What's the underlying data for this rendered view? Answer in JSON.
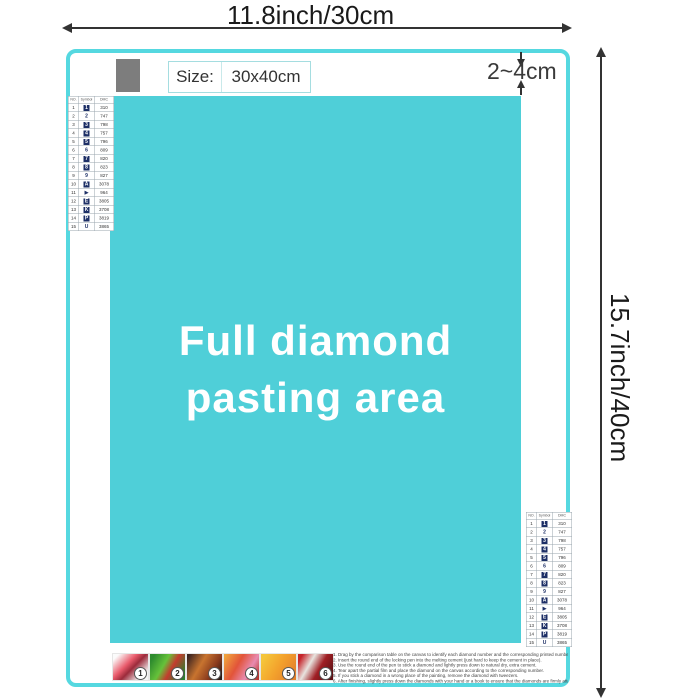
{
  "dimensions": {
    "width_label": "11.8inch/30cm",
    "height_label": "15.7inch/40cm",
    "margin_label": "2~4cm"
  },
  "size_box": {
    "label": "Size:",
    "value": "30x40cm"
  },
  "pasting_area": {
    "line1": "Full diamond",
    "line2": "pasting area",
    "fill_color": "#4fcfd8",
    "border_color": "#55d8e0",
    "gray_swatch_color": "#7d7d7d"
  },
  "color_chart": {
    "headers": {
      "no": "NO.",
      "symbol": "Symbol",
      "code": "DMC"
    },
    "symbol_fill_color": "#1d2f66",
    "rows": [
      {
        "no": "1",
        "symbol": "1",
        "code": "310",
        "filled": true
      },
      {
        "no": "2",
        "symbol": "2",
        "code": "747",
        "filled": false
      },
      {
        "no": "3",
        "symbol": "3",
        "code": "798",
        "filled": true
      },
      {
        "no": "4",
        "symbol": "4",
        "code": "757",
        "filled": true
      },
      {
        "no": "5",
        "symbol": "5",
        "code": "796",
        "filled": true
      },
      {
        "no": "6",
        "symbol": "6",
        "code": "809",
        "filled": false
      },
      {
        "no": "7",
        "symbol": "7",
        "code": "820",
        "filled": true
      },
      {
        "no": "8",
        "symbol": "8",
        "code": "823",
        "filled": true
      },
      {
        "no": "9",
        "symbol": "9",
        "code": "827",
        "filled": false
      },
      {
        "no": "10",
        "symbol": "A",
        "code": "3078",
        "filled": true
      },
      {
        "no": "11",
        "symbol": "▶",
        "code": "964",
        "filled": false
      },
      {
        "no": "12",
        "symbol": "E",
        "code": "3805",
        "filled": true
      },
      {
        "no": "13",
        "symbol": "K",
        "code": "3708",
        "filled": true
      },
      {
        "no": "14",
        "symbol": "P",
        "code": "3819",
        "filled": true
      },
      {
        "no": "15",
        "symbol": "U",
        "code": "3865",
        "filled": false
      }
    ]
  },
  "steps": {
    "images": [
      {
        "num": "1",
        "bg": "linear-gradient(135deg, #fbfbfb 10%, #e8596a 40%, #9c2b3b 55%, #f3f3f3 85%)"
      },
      {
        "num": "2",
        "bg": "linear-gradient(120deg, #2e8b2e 10%, #66c23a 40%, #c43b2e 60%, #2e7d2e 90%)"
      },
      {
        "num": "3",
        "bg": "linear-gradient(120deg, #3a2320 5%, #c8742f 40%, #8a3b1d 70%, #2b1a14 95%)"
      },
      {
        "num": "4",
        "bg": "linear-gradient(120deg, #f0a23c 5%, #e2543a 40%, #e88bb0 70%, #b8352f 95%)"
      },
      {
        "num": "5",
        "bg": "linear-gradient(120deg, #f5c53a 10%, #f3a12c 50%, #e4812b 90%)"
      },
      {
        "num": "6",
        "bg": "linear-gradient(120deg, #c6252b 10%, #e8e4df 35%, #a01f24 60%, #5f1114 90%)"
      }
    ],
    "instructions": [
      {
        "text": "1. Drag by the comparison table on the canvas to identify each diamond number and the corresponding printed number on the canvas."
      },
      {
        "text": "2. Insert the round end of the locking pen into the melting cement (just hard to keep the cement in place)."
      },
      {
        "text": "3. Use the round end of the pen to stick a diamond and lightly press down to natural dry, extra cement."
      },
      {
        "text": "4. Tear apart the partial film and place the diamond on the canvas according to the corresponding number."
      },
      {
        "text": "5. If you stick a diamond in a wrong place of the painting, remove the diamond with tweezers."
      },
      {
        "text": "6. After finishing, slightly press down the diamonds with your hand or a book to ensure that the diamonds are firmly attached."
      }
    ]
  }
}
